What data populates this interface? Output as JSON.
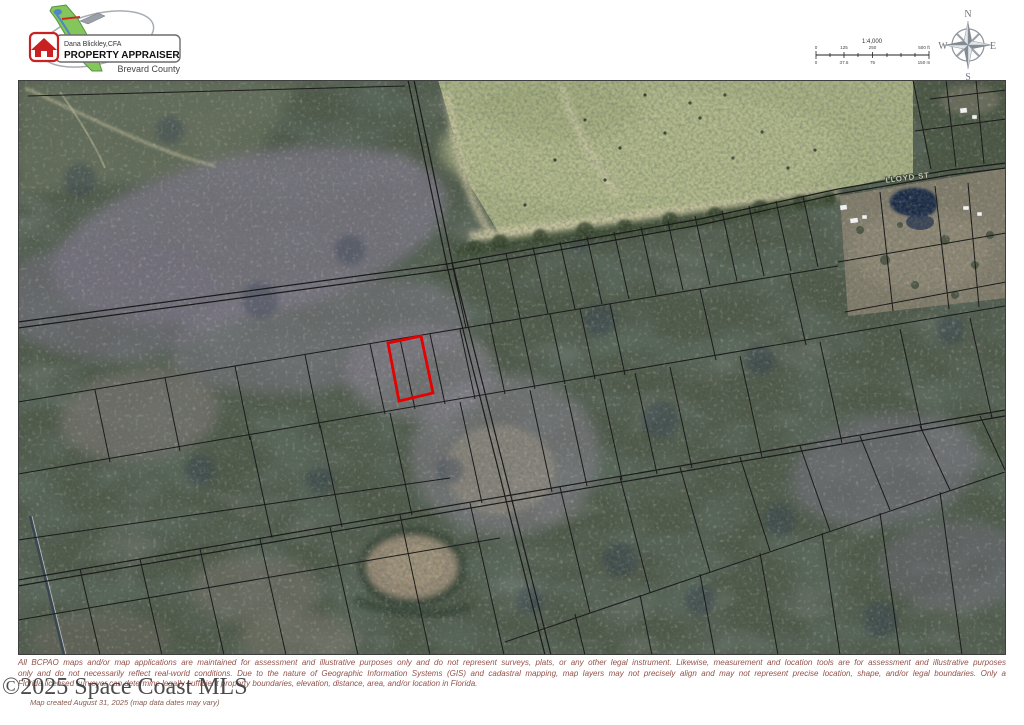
{
  "header": {
    "logo": {
      "name_line": "Dana Blickley,CFA",
      "title_line": "PROPERTY APPRAISER",
      "county_line": "Brevard County"
    }
  },
  "scale_bar": {
    "ratio": "1:4,000",
    "feet_labels": [
      "0",
      "125",
      "250",
      "500 ft"
    ],
    "meter_labels": [
      "0",
      "37.5",
      "75",
      "150 m"
    ]
  },
  "compass": {
    "north": "N",
    "east": "E",
    "south": "S",
    "west": "W"
  },
  "map": {
    "street_label": "LLOYD ST",
    "highlighted_parcel_color": "#e60000"
  },
  "footer": {
    "disclaimer_line1": "All BCPAO maps and/or map applications are maintained for assessment and illustrative purposes only and do not represent surveys, plats, or any other legal instrument. Likewise, measurement and location tools are for assessment and illustrative purposes",
    "disclaimer_line2": "only and do not necessarily reflect real-world conditions. Due to the nature of Geographic Information Systems (GIS) and cadastral mapping, map layers may not precisely align and may not represent precise location, shape, and/or legal boundaries. Only a",
    "disclaimer_line3": "Florida licensed surveyor can determine legally sufficient property boundaries, elevation, distance, area, and/or location in Florida.",
    "watermark": "©2025 Space Coast MLS",
    "created_note": "Map created August 31, 2025 (map data dates may vary)"
  },
  "colors": {
    "parcel_line": "#1b1b1b",
    "highlight_red": "#e60000",
    "forest_base": "#4e5848",
    "pasture": "#a9b183",
    "pond_navy": "#1b2a46",
    "disclaimer_text": "#92524a"
  }
}
